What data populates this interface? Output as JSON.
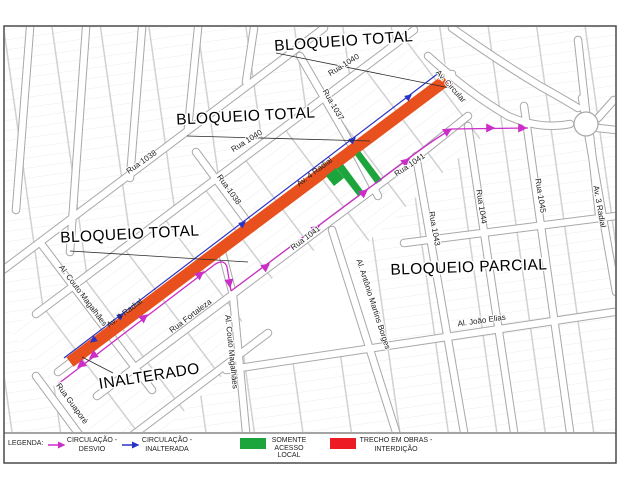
{
  "map": {
    "zone_labels": [
      {
        "text": "BLOQUEIO TOTAL"
      },
      {
        "text": "BLOQUEIO TOTAL"
      },
      {
        "text": "BLOQUEIO TOTAL"
      },
      {
        "text": "BLOQUEIO PARCIAL"
      },
      {
        "text": "INALTERADO"
      }
    ],
    "street_labels": [
      {
        "text": "Rua 1040"
      },
      {
        "text": "Rua 1040"
      },
      {
        "text": "Rua 1037"
      },
      {
        "text": "Rua 1038"
      },
      {
        "text": "Rua 1038"
      },
      {
        "text": "Av. Circular"
      },
      {
        "text": "Av. 4 Radial"
      },
      {
        "text": "Av. 4 Radial"
      },
      {
        "text": "Rua 1041"
      },
      {
        "text": "Rua 1041"
      },
      {
        "text": "Rua 1043"
      },
      {
        "text": "Rua 1044"
      },
      {
        "text": "Rua 1045"
      },
      {
        "text": "Av. 3 Radial"
      },
      {
        "text": "Al. Antônio Martins Borges"
      },
      {
        "text": "Al. João Elias"
      },
      {
        "text": "Al. Couto Magalhães"
      },
      {
        "text": "Al. Couto Magalhães"
      },
      {
        "text": "Rua Fortaleza"
      },
      {
        "text": "Rua Guaporé"
      }
    ]
  },
  "legend": {
    "title": "LEGENDA:",
    "items": [
      {
        "symbol": "arrow-magenta",
        "color": "#CB2EC8",
        "lines": [
          "CIRCULAÇÃO -",
          "DESVIO"
        ]
      },
      {
        "symbol": "arrow-blue",
        "color": "#2B33C4",
        "lines": [
          "CIRCULAÇÃO -",
          "INALTERADA"
        ]
      },
      {
        "symbol": "swatch-green",
        "color": "#1CA53C",
        "lines": [
          "SOMENTE",
          "ACESSO",
          "LOCAL"
        ]
      },
      {
        "symbol": "swatch-red",
        "color": "#ED1C24",
        "lines": [
          "TRECHO EM OBRAS -",
          "INTERDIÇÃO"
        ]
      }
    ]
  },
  "colors": {
    "works_band": "#E8501D",
    "local_access": "#1CA53C",
    "detour": "#CB2EC8",
    "unaltered": "#2B33C4"
  }
}
